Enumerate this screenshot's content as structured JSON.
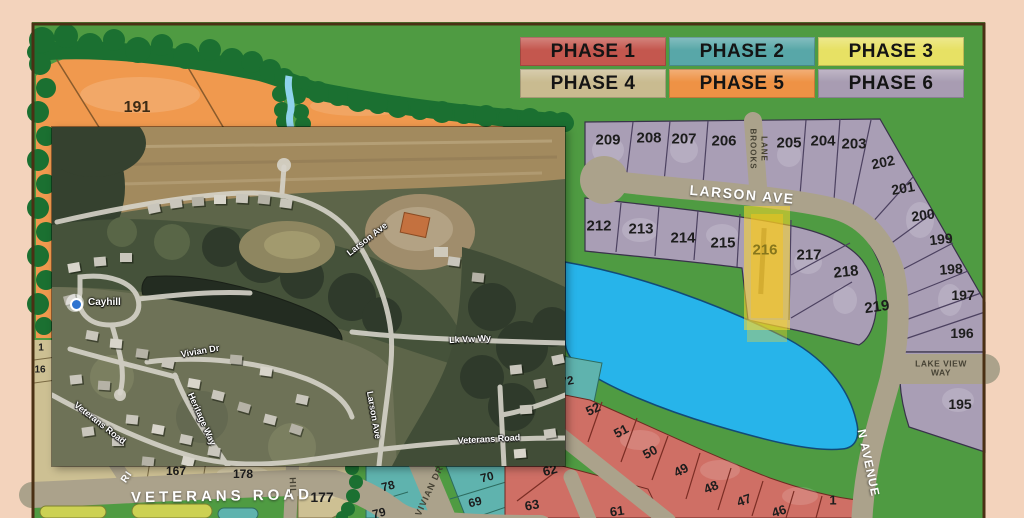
{
  "colors": {
    "page_border": "#f3d3bc",
    "map_green": "#4f9b42",
    "tree_green": "#1b7031",
    "road": "#aba28b",
    "pond_blue": "#27b4ea",
    "stream_blue": "#8fd3ec",
    "highlight_yellow": "#fcd82c",
    "phase1": "#cf6f65",
    "phase2": "#5fb3ae",
    "phase3": "#e7e164",
    "phase4": "#cdc093",
    "phase5": "#f0994e",
    "phase6": "#a99eb5"
  },
  "legend": {
    "items": [
      {
        "label": "PHASE 1",
        "color": "#c4574e"
      },
      {
        "label": "PHASE 2",
        "color": "#58a7a8"
      },
      {
        "label": "PHASE 3",
        "color": "#e7e164"
      },
      {
        "label": "PHASE 4",
        "color": "#c9bb90"
      },
      {
        "label": "PHASE 5",
        "color": "#ee9245"
      },
      {
        "label": "PHASE 6",
        "color": "#a89cb2"
      }
    ]
  },
  "plat": {
    "street_labels": [
      {
        "id": "larson-ave",
        "text": "LARSON AVE",
        "x": 742,
        "y": 195,
        "rot": 5,
        "cls": "road-white",
        "size": 14,
        "ls": 1.5
      },
      {
        "id": "brooks-lane-1",
        "text": "BROOKS",
        "x": 752,
        "y": 149,
        "rot": 90,
        "cls": "road-dark",
        "size": 8,
        "ls": 1
      },
      {
        "id": "brooks-lane-2",
        "text": "LANE",
        "x": 763,
        "y": 149,
        "rot": 90,
        "cls": "road-dark",
        "size": 8,
        "ls": 1
      },
      {
        "id": "lake-view-way",
        "text": "LAKE VIEW\nWAY",
        "x": 941,
        "y": 369,
        "rot": 0,
        "cls": "road-dark",
        "size": 8.5,
        "ls": 0.5
      },
      {
        "id": "n-avenue",
        "text": "N AVENUE",
        "x": 868,
        "y": 463,
        "rot": 78,
        "cls": "road-white",
        "size": 12,
        "ls": 1
      },
      {
        "id": "veterans-road",
        "text": "VETERANS ROAD",
        "x": 222,
        "y": 497,
        "rot": -1,
        "cls": "road-white",
        "size": 15,
        "ls": 4
      },
      {
        "id": "vivian-dr",
        "text": "VIVIAN DR",
        "x": 430,
        "y": 491,
        "rot": -65,
        "cls": "road-dark",
        "size": 9,
        "ls": 1
      },
      {
        "id": "hill-fragment",
        "text": "HIL",
        "x": 292,
        "y": 486,
        "rot": 88,
        "cls": "road-dark",
        "size": 9,
        "ls": 1
      },
      {
        "id": "ri-fragment",
        "text": "RI",
        "x": 127,
        "y": 477,
        "rot": -55,
        "cls": "road-white",
        "size": 10,
        "ls": 1
      }
    ],
    "lot_labels": [
      {
        "n": "191",
        "x": 137,
        "y": 108,
        "size": 16,
        "color": "#3d2b15"
      },
      {
        "n": "209",
        "x": 608,
        "y": 140,
        "size": 15
      },
      {
        "n": "208",
        "x": 649,
        "y": 138,
        "size": 15
      },
      {
        "n": "207",
        "x": 684,
        "y": 139,
        "size": 15
      },
      {
        "n": "206",
        "x": 724,
        "y": 141,
        "size": 15
      },
      {
        "n": "205",
        "x": 789,
        "y": 143,
        "size": 15
      },
      {
        "n": "204",
        "x": 823,
        "y": 141,
        "size": 15
      },
      {
        "n": "203",
        "x": 854,
        "y": 144,
        "size": 15
      },
      {
        "n": "202",
        "x": 883,
        "y": 162,
        "size": 14,
        "rot": -12
      },
      {
        "n": "201",
        "x": 903,
        "y": 188,
        "size": 14,
        "rot": -10
      },
      {
        "n": "200",
        "x": 923,
        "y": 215,
        "size": 14,
        "rot": -8
      },
      {
        "n": "199",
        "x": 941,
        "y": 239,
        "size": 14,
        "rot": -6
      },
      {
        "n": "198",
        "x": 951,
        "y": 269,
        "size": 14,
        "rot": -4
      },
      {
        "n": "197",
        "x": 963,
        "y": 295,
        "size": 14
      },
      {
        "n": "196",
        "x": 962,
        "y": 333,
        "size": 14
      },
      {
        "n": "195",
        "x": 960,
        "y": 404,
        "size": 14
      },
      {
        "n": "212",
        "x": 599,
        "y": 226,
        "size": 15
      },
      {
        "n": "213",
        "x": 641,
        "y": 229,
        "size": 15
      },
      {
        "n": "214",
        "x": 683,
        "y": 238,
        "size": 15
      },
      {
        "n": "215",
        "x": 723,
        "y": 243,
        "size": 15
      },
      {
        "n": "216",
        "x": 765,
        "y": 250,
        "size": 15,
        "color": "#86761c"
      },
      {
        "n": "217",
        "x": 809,
        "y": 255,
        "size": 15
      },
      {
        "n": "218",
        "x": 846,
        "y": 272,
        "size": 15,
        "rot": -6
      },
      {
        "n": "219",
        "x": 877,
        "y": 307,
        "size": 15,
        "rot": -8
      },
      {
        "n": "52",
        "x": 593,
        "y": 409,
        "size": 13,
        "rot": -25
      },
      {
        "n": "51",
        "x": 621,
        "y": 431,
        "size": 13,
        "rot": -28
      },
      {
        "n": "50",
        "x": 650,
        "y": 452,
        "size": 13,
        "rot": -28
      },
      {
        "n": "49",
        "x": 681,
        "y": 470,
        "size": 13,
        "rot": -28
      },
      {
        "n": "48",
        "x": 711,
        "y": 487,
        "size": 13,
        "rot": -24
      },
      {
        "n": "47",
        "x": 744,
        "y": 500,
        "size": 13,
        "rot": -20
      },
      {
        "n": "46",
        "x": 779,
        "y": 511,
        "size": 13,
        "rot": -18
      },
      {
        "n": "1",
        "x": 833,
        "y": 500,
        "size": 13
      },
      {
        "n": "61",
        "x": 617,
        "y": 511,
        "size": 13,
        "rot": -8
      },
      {
        "n": "62",
        "x": 550,
        "y": 470,
        "size": 13,
        "rot": -15
      },
      {
        "n": "63",
        "x": 532,
        "y": 505,
        "size": 13,
        "rot": -10
      },
      {
        "n": "70",
        "x": 487,
        "y": 477,
        "size": 12,
        "rot": -14
      },
      {
        "n": "69",
        "x": 475,
        "y": 502,
        "size": 12,
        "rot": -14
      },
      {
        "n": "78",
        "x": 388,
        "y": 486,
        "size": 12,
        "rot": -14
      },
      {
        "n": "79",
        "x": 379,
        "y": 513,
        "size": 12,
        "rot": -14
      },
      {
        "n": "72",
        "x": 567,
        "y": 381,
        "size": 12,
        "rot": -10
      },
      {
        "n": "167",
        "x": 176,
        "y": 471,
        "size": 12
      },
      {
        "n": "178",
        "x": 243,
        "y": 474,
        "size": 12
      },
      {
        "n": "177",
        "x": 322,
        "y": 497,
        "size": 14
      },
      {
        "n": "1",
        "x": 41,
        "y": 348,
        "size": 10
      },
      {
        "n": "16",
        "x": 40,
        "y": 370,
        "size": 10
      }
    ]
  },
  "inset": {
    "place": {
      "name": "Cayhill",
      "x": 36,
      "y": 176,
      "pin_x": 23,
      "pin_y": 176
    },
    "labels": [
      {
        "id": "inset-larson-ave-diag",
        "text": "Larson Ave",
        "x": 315,
        "y": 112,
        "rot": -38
      },
      {
        "id": "inset-lk-vw-wy",
        "text": "Lk Vw Wy",
        "x": 418,
        "y": 212,
        "rot": -3
      },
      {
        "id": "inset-vivian-dr",
        "text": "Vivian Dr",
        "x": 148,
        "y": 224,
        "rot": -10
      },
      {
        "id": "inset-heritage-way",
        "text": "Heritage Way",
        "x": 150,
        "y": 292,
        "rot": 66
      },
      {
        "id": "inset-larson-ave-vert",
        "text": "Larson Ave",
        "x": 322,
        "y": 288,
        "rot": 80
      },
      {
        "id": "inset-veterans-road-diag",
        "text": "Veterans Road",
        "x": 48,
        "y": 296,
        "rot": 38
      },
      {
        "id": "inset-veterans-road",
        "text": "Veterans Road",
        "x": 437,
        "y": 312,
        "rot": -3
      }
    ]
  }
}
